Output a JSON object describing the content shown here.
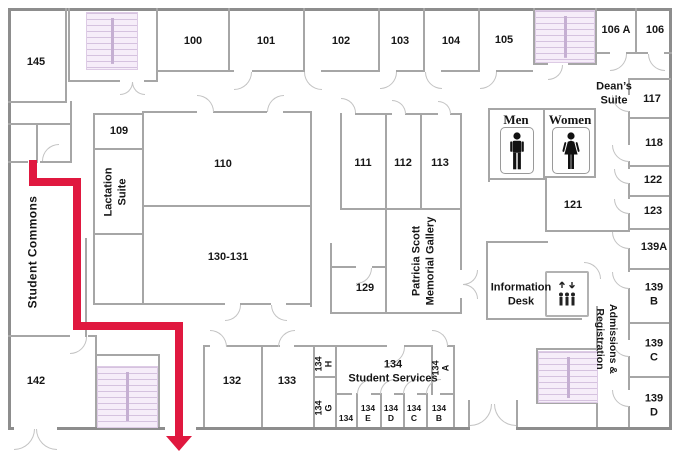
{
  "map": {
    "colors": {
      "route": "#e0183f",
      "stairs_fill": "#f6edf9",
      "wall_exterior": "#8d8d8d",
      "wall_interior": "#a6a6a6"
    },
    "rooms": {
      "r145": "145",
      "r100": "100",
      "r101": "101",
      "r102": "102",
      "r103": "103",
      "r104": "104",
      "r105": "105",
      "r106a": "106 A",
      "r106": "106",
      "deans": "Dean’s\nSuite",
      "r117": "117",
      "r118": "118",
      "r122": "122",
      "r123": "123",
      "r139a": "139A",
      "r139b": "139 B",
      "r139c": "139 C",
      "r139d": "139 D",
      "r109": "109",
      "lactation": "Lactation\nSuite",
      "commons": "Student Commons",
      "r110": "110",
      "r130": "130-131",
      "r111": "111",
      "r112": "112",
      "r113": "113",
      "gallery": "Patricia Scott\nMemorial Gallery",
      "r129": "129",
      "men": "Men",
      "women": "Women",
      "r121": "121",
      "info": "Information\nDesk",
      "admissions": "Admissions &\nRegistration",
      "r142": "142",
      "r132": "132",
      "r133": "133",
      "r134h": "134\nH",
      "r134g": "134\nG",
      "r134a": "134\nA",
      "r134ss": "134\nStudent Services",
      "r134": "134",
      "r134e": "134\nE",
      "r134d": "134\nD",
      "r134c": "134\nC",
      "r134b": "134\nB"
    }
  }
}
